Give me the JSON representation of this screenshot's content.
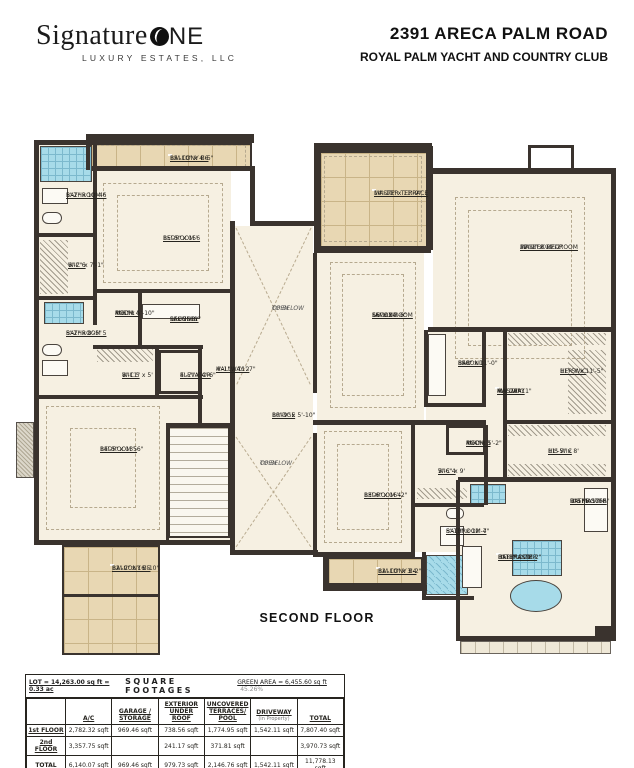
{
  "header": {
    "logo_script": "Signature",
    "logo_one": "NE",
    "logo_sub": "LUXURY ESTATES, LLC",
    "address": "2391 ARECA PALM ROAD",
    "community": "ROYAL PALM YACHT AND COUNTRY CLUB"
  },
  "floor_label": "SECOND FLOOR",
  "plan": {
    "floors": [
      {
        "x": 39,
        "y": 145,
        "w": 192,
        "h": 395
      },
      {
        "x": 235,
        "y": 226,
        "w": 78,
        "h": 324
      },
      {
        "x": 317,
        "y": 253,
        "w": 107,
        "h": 167
      },
      {
        "x": 433,
        "y": 174,
        "w": 178,
        "h": 153
      },
      {
        "x": 426,
        "y": 332,
        "w": 185,
        "h": 145
      },
      {
        "x": 460,
        "y": 482,
        "w": 151,
        "h": 154
      },
      {
        "x": 317,
        "y": 425,
        "w": 167,
        "h": 127
      }
    ],
    "balconies": [
      {
        "x": 90,
        "y": 143,
        "w": 162,
        "h": 27
      },
      {
        "x": 319,
        "y": 151,
        "w": 109,
        "h": 97
      },
      {
        "x": 327,
        "y": 557,
        "w": 96,
        "h": 28
      },
      {
        "x": 62,
        "y": 545,
        "w": 98,
        "h": 110
      }
    ],
    "band": [
      {
        "x": 460,
        "y": 641,
        "w": 151,
        "h": 13
      }
    ],
    "tiles": [
      {
        "x": 40,
        "y": 146,
        "w": 52,
        "h": 36
      },
      {
        "x": 44,
        "y": 302,
        "w": 40,
        "h": 22
      },
      {
        "x": 426,
        "y": 555,
        "w": 42,
        "h": 40,
        "d": 1
      },
      {
        "x": 512,
        "y": 540,
        "w": 50,
        "h": 36
      },
      {
        "x": 470,
        "y": 484,
        "w": 36,
        "h": 20
      }
    ],
    "stairs": [
      {
        "x": 168,
        "y": 426,
        "w": 62,
        "h": 112
      }
    ],
    "hatches": [
      {
        "x": 40,
        "y": 240,
        "w": 28,
        "h": 54
      },
      {
        "x": 97,
        "y": 349,
        "w": 56,
        "h": 13
      },
      {
        "x": 508,
        "y": 333,
        "w": 98,
        "h": 12
      },
      {
        "x": 568,
        "y": 350,
        "w": 38,
        "h": 64
      },
      {
        "x": 508,
        "y": 425,
        "w": 98,
        "h": 11
      },
      {
        "x": 508,
        "y": 464,
        "w": 98,
        "h": 12
      },
      {
        "x": 417,
        "y": 488,
        "w": 50,
        "h": 11
      }
    ],
    "crosses": [
      {
        "x": 236,
        "y": 228,
        "w": 75,
        "h": 158
      },
      {
        "x": 236,
        "y": 437,
        "w": 75,
        "h": 110
      }
    ],
    "dashes": [
      {
        "x": 103,
        "y": 183,
        "w": 120,
        "h": 100
      },
      {
        "x": 117,
        "y": 195,
        "w": 92,
        "h": 76
      },
      {
        "x": 46,
        "y": 406,
        "w": 114,
        "h": 124
      },
      {
        "x": 70,
        "y": 428,
        "w": 66,
        "h": 80
      },
      {
        "x": 455,
        "y": 197,
        "w": 130,
        "h": 162
      },
      {
        "x": 468,
        "y": 210,
        "w": 104,
        "h": 136
      },
      {
        "x": 330,
        "y": 262,
        "w": 86,
        "h": 146
      },
      {
        "x": 342,
        "y": 274,
        "w": 62,
        "h": 122
      },
      {
        "x": 324,
        "y": 431,
        "w": 78,
        "h": 112
      },
      {
        "x": 337,
        "y": 444,
        "w": 52,
        "h": 86
      },
      {
        "x": 324,
        "y": 156,
        "w": 98,
        "h": 86
      },
      {
        "x": 96,
        "y": 145,
        "w": 150,
        "h": 22
      }
    ],
    "fixtures": [
      {
        "x": 42,
        "y": 188,
        "w": 26,
        "h": 16
      },
      {
        "x": 42,
        "y": 212,
        "w": 20,
        "h": 12,
        "r": 6
      },
      {
        "x": 42,
        "y": 344,
        "w": 20,
        "h": 12,
        "r": 6
      },
      {
        "x": 42,
        "y": 360,
        "w": 26,
        "h": 16
      },
      {
        "x": 142,
        "y": 304,
        "w": 58,
        "h": 15
      },
      {
        "x": 428,
        "y": 334,
        "w": 18,
        "h": 62
      },
      {
        "x": 446,
        "y": 508,
        "w": 18,
        "h": 11,
        "r": 5
      },
      {
        "x": 440,
        "y": 526,
        "w": 24,
        "h": 20
      },
      {
        "x": 584,
        "y": 488,
        "w": 24,
        "h": 44
      },
      {
        "x": 462,
        "y": 546,
        "w": 20,
        "h": 42
      }
    ],
    "tubs": [
      {
        "x": 510,
        "y": 580,
        "w": 52,
        "h": 32
      }
    ],
    "misc": [
      {
        "c": "chim",
        "x": 16,
        "y": 422,
        "w": 18,
        "h": 56
      },
      {
        "c": "notch",
        "x": 528,
        "y": 145,
        "w": 46,
        "h": 26
      },
      {
        "c": "elevbox",
        "x": 158,
        "y": 350,
        "w": 44,
        "h": 44
      },
      {
        "c": "mechbox",
        "x": 446,
        "y": 425,
        "w": 40,
        "h": 30
      }
    ],
    "walls": [
      {
        "x": 34,
        "y": 140,
        "w": 64,
        "h": 5
      },
      {
        "x": 34,
        "y": 140,
        "w": 5,
        "h": 405
      },
      {
        "x": 86,
        "y": 134,
        "w": 168,
        "h": 9
      },
      {
        "x": 86,
        "y": 134,
        "w": 4,
        "h": 36
      },
      {
        "x": 92,
        "y": 166,
        "w": 163,
        "h": 5
      },
      {
        "x": 250,
        "y": 166,
        "w": 5,
        "h": 60
      },
      {
        "x": 250,
        "y": 221,
        "w": 68,
        "h": 5
      },
      {
        "x": 230,
        "y": 221,
        "w": 5,
        "h": 334
      },
      {
        "x": 34,
        "y": 540,
        "w": 200,
        "h": 5
      },
      {
        "x": 232,
        "y": 550,
        "w": 86,
        "h": 5
      },
      {
        "x": 314,
        "y": 143,
        "w": 118,
        "h": 8
      },
      {
        "x": 314,
        "y": 143,
        "w": 5,
        "h": 110
      },
      {
        "x": 428,
        "y": 146,
        "w": 5,
        "h": 104
      },
      {
        "x": 314,
        "y": 248,
        "w": 117,
        "h": 5
      },
      {
        "x": 428,
        "y": 168,
        "w": 188,
        "h": 6
      },
      {
        "x": 611,
        "y": 168,
        "w": 5,
        "h": 472
      },
      {
        "x": 428,
        "y": 327,
        "w": 188,
        "h": 5
      },
      {
        "x": 313,
        "y": 253,
        "w": 4,
        "h": 140
      },
      {
        "x": 313,
        "y": 433,
        "w": 4,
        "h": 122
      },
      {
        "x": 424,
        "y": 330,
        "w": 4,
        "h": 77
      },
      {
        "x": 424,
        "y": 403,
        "w": 60,
        "h": 4
      },
      {
        "x": 482,
        "y": 330,
        "w": 4,
        "h": 77
      },
      {
        "x": 503,
        "y": 330,
        "w": 4,
        "h": 151
      },
      {
        "x": 505,
        "y": 420,
        "w": 108,
        "h": 4
      },
      {
        "x": 458,
        "y": 477,
        "w": 155,
        "h": 5
      },
      {
        "x": 313,
        "y": 420,
        "w": 173,
        "h": 5
      },
      {
        "x": 411,
        "y": 425,
        "w": 4,
        "h": 130
      },
      {
        "x": 484,
        "y": 425,
        "w": 4,
        "h": 80
      },
      {
        "x": 415,
        "y": 503,
        "w": 69,
        "h": 4
      },
      {
        "x": 313,
        "y": 552,
        "w": 102,
        "h": 5
      },
      {
        "x": 323,
        "y": 585,
        "w": 104,
        "h": 6
      },
      {
        "x": 323,
        "y": 557,
        "w": 4,
        "h": 32
      },
      {
        "x": 456,
        "y": 480,
        "w": 4,
        "h": 160
      },
      {
        "x": 456,
        "y": 636,
        "w": 160,
        "h": 5
      },
      {
        "x": 93,
        "y": 145,
        "w": 4,
        "h": 180
      },
      {
        "x": 38,
        "y": 233,
        "w": 58,
        "h": 4
      },
      {
        "x": 38,
        "y": 296,
        "w": 58,
        "h": 4
      },
      {
        "x": 93,
        "y": 289,
        "w": 141,
        "h": 4
      },
      {
        "x": 138,
        "y": 293,
        "w": 4,
        "h": 55
      },
      {
        "x": 93,
        "y": 345,
        "w": 110,
        "h": 4
      },
      {
        "x": 155,
        "y": 347,
        "w": 4,
        "h": 50
      },
      {
        "x": 198,
        "y": 347,
        "w": 4,
        "h": 76
      },
      {
        "x": 38,
        "y": 395,
        "w": 165,
        "h": 4
      },
      {
        "x": 166,
        "y": 423,
        "w": 3,
        "h": 120
      },
      {
        "x": 168,
        "y": 423,
        "w": 65,
        "h": 3
      },
      {
        "x": 422,
        "y": 552,
        "w": 4,
        "h": 48
      },
      {
        "x": 422,
        "y": 596,
        "w": 52,
        "h": 4
      },
      {
        "x": 62,
        "y": 594,
        "w": 98,
        "h": 3
      },
      {
        "x": 595,
        "y": 626,
        "w": 20,
        "h": 12
      }
    ],
    "labels": [
      {
        "x": 170,
        "y": 155,
        "chip": 1,
        "lines": [
          {
            "t": "BALCONY B6",
            "u": 1
          },
          {
            "t": "15'-10\" x 4'-5\""
          }
        ]
      },
      {
        "x": 66,
        "y": 192,
        "lines": [
          {
            "t": "BATHROOM 6",
            "u": 1
          },
          {
            "t": "5'-2\" x 10'-4\""
          }
        ]
      },
      {
        "x": 163,
        "y": 235,
        "lines": [
          {
            "t": "BEDROOM 6",
            "u": 1
          },
          {
            "t": "15'-5\" x 15'"
          }
        ]
      },
      {
        "x": 68,
        "y": 262,
        "lines": [
          {
            "t": "WIC 6",
            "u": 1
          },
          {
            "t": "6'-2\" x 7'-1\""
          }
        ]
      },
      {
        "x": 115,
        "y": 310,
        "lines": [
          {
            "t": "MECH.",
            "u": 1
          },
          {
            "t": "ROOM 4",
            "u": 1
          },
          {
            "t": "4'-6\" x 5'-10\""
          }
        ]
      },
      {
        "x": 170,
        "y": 316,
        "lines": [
          {
            "t": "SECOND",
            "u": 1
          },
          {
            "t": "LAUNDRY",
            "u": 1
          },
          {
            "t": "9' x 7'-11\""
          }
        ]
      },
      {
        "x": 66,
        "y": 330,
        "lines": [
          {
            "t": "BATHROOM 5",
            "u": 1
          },
          {
            "t": "5'-2\" x 8'-5\""
          }
        ]
      },
      {
        "x": 122,
        "y": 372,
        "lines": [
          {
            "t": "WIC 5",
            "u": 1
          },
          {
            "t": "8'-11\" x 5'"
          }
        ]
      },
      {
        "x": 180,
        "y": 372,
        "lines": [
          {
            "t": "ELEVATOR",
            "u": 1
          },
          {
            "t": "4'-7\" x 4'-6\""
          }
        ]
      },
      {
        "x": 216,
        "y": 366,
        "lines": [
          {
            "t": "HALLWAY 2",
            "u": 1
          },
          {
            "t": "4'-1\" x 11'-7\""
          }
        ]
      },
      {
        "x": 100,
        "y": 446,
        "lines": [
          {
            "t": "BEDROOM 5",
            "u": 1
          },
          {
            "t": "14'-5\" x 13'-6\""
          }
        ]
      },
      {
        "x": 272,
        "y": 305,
        "lines": [
          {
            "t": "OPEN",
            "i": 1
          },
          {
            "t": "TO BELOW",
            "i": 1
          }
        ]
      },
      {
        "x": 272,
        "y": 412,
        "lines": [
          {
            "t": "BRIDGE",
            "u": 1
          },
          {
            "t": "10'-9\" x 5'-10\""
          }
        ]
      },
      {
        "x": 260,
        "y": 460,
        "lines": [
          {
            "t": "OPEN",
            "i": 1
          },
          {
            "t": "TO BELOW",
            "i": 1
          }
        ]
      },
      {
        "x": 372,
        "y": 312,
        "lines": [
          {
            "t": "SECOND",
            "u": 1
          },
          {
            "t": "FAMILY ROOM",
            "u": 1
          },
          {
            "t": "16' x 24'-6\""
          }
        ]
      },
      {
        "x": 374,
        "y": 190,
        "chip": 1,
        "lines": [
          {
            "t": "MASTER TERRACE",
            "u": 1
          },
          {
            "t": "14'-10\" x 11'-9\""
          }
        ]
      },
      {
        "x": 520,
        "y": 244,
        "lines": [
          {
            "t": "MASTER BEDROOM",
            "u": 1
          },
          {
            "t": "BEDROOM 3",
            "i": 1
          },
          {
            "t": "22'-1\" x 19'-2\""
          }
        ]
      },
      {
        "x": 458,
        "y": 360,
        "lines": [
          {
            "t": "SECOND",
            "u": 1
          },
          {
            "t": "BAR",
            "u": 1
          },
          {
            "t": "8'-0\" x 11'-0\""
          }
        ]
      },
      {
        "x": 497,
        "y": 388,
        "chip": 1,
        "lines": [
          {
            "t": "MASTER",
            "u": 1
          },
          {
            "t": "HALLWAY",
            "u": 1
          },
          {
            "t": "4' x 24'-11\""
          }
        ]
      },
      {
        "x": 560,
        "y": 368,
        "lines": [
          {
            "t": "HER WIC",
            "u": 1
          },
          {
            "t": "11'-5\" x 11'-5\""
          }
        ]
      },
      {
        "x": 548,
        "y": 448,
        "lines": [
          {
            "t": "HIS WIC",
            "u": 1
          },
          {
            "t": "11'-5\" x 8'"
          }
        ]
      },
      {
        "x": 466,
        "y": 440,
        "lines": [
          {
            "t": "MECH.",
            "u": 1
          },
          {
            "t": "ROOM 3",
            "u": 1
          },
          {
            "t": "4'-4\" x 5'-2\""
          }
        ]
      },
      {
        "x": 438,
        "y": 468,
        "lines": [
          {
            "t": "WIC 4",
            "u": 1
          },
          {
            "t": "5'-6\" x 9'"
          }
        ]
      },
      {
        "x": 364,
        "y": 492,
        "lines": [
          {
            "t": "BEDROOM 4",
            "u": 1
          },
          {
            "t": "13'-6\" x 16'-2\""
          }
        ]
      },
      {
        "x": 446,
        "y": 528,
        "chip": 1,
        "lines": [
          {
            "t": "BATHROOM 4",
            "u": 1
          },
          {
            "t": "5'-10\" x 12'-7\""
          }
        ]
      },
      {
        "x": 570,
        "y": 498,
        "lines": [
          {
            "t": "HIS MASTER",
            "u": 1
          },
          {
            "t": "BATHROOM",
            "u": 1
          },
          {
            "t": "9'-5\" x 17'-6\""
          }
        ]
      },
      {
        "x": 498,
        "y": 554,
        "chip": 1,
        "lines": [
          {
            "t": "HER MASTER",
            "u": 1
          },
          {
            "t": "BATHROOM",
            "u": 1
          },
          {
            "t": "8'-11\" x 21'-2\""
          }
        ]
      },
      {
        "x": 378,
        "y": 568,
        "chip": 1,
        "lines": [
          {
            "t": "BALCONY B4",
            "u": 1
          },
          {
            "t": "11'-10\" x 3'-2\""
          }
        ]
      },
      {
        "x": 112,
        "y": 565,
        "chip": 1,
        "lines": [
          {
            "t": "BALCONY B5",
            "u": 1
          },
          {
            "t": "12'-9\" x 16'-10\""
          }
        ]
      }
    ]
  },
  "table": {
    "lot_label": "LOT = 14,263.00 sq ft = 0.33 ac",
    "title": "SQUARE FOOTAGES",
    "green_label": "GREEN AREA = 6,455.60 sq ft",
    "green_pct": "45.26%",
    "columns": [
      {
        "lines": [
          {
            "t": "A/C",
            "u": 1
          }
        ]
      },
      {
        "lines": [
          {
            "t": "GARAGE /",
            "u": 1
          },
          {
            "t": "STORAGE",
            "u": 1
          }
        ]
      },
      {
        "lines": [
          {
            "t": "EXTERIOR",
            "u": 1
          },
          {
            "t": "UNDER ROOF",
            "u": 1
          }
        ]
      },
      {
        "lines": [
          {
            "t": "UNCOVERED",
            "u": 1
          },
          {
            "t": "TERRACES/ POOL",
            "u": 1
          }
        ]
      },
      {
        "lines": [
          {
            "t": "DRIVEWAY",
            "u": 1
          },
          {
            "t": "(in Property)",
            "small": 1
          }
        ]
      },
      {
        "lines": [
          {
            "t": "TOTAL",
            "u": 1
          }
        ]
      }
    ],
    "rows": [
      {
        "label": "1st FLOOR",
        "cells": [
          "2,782.32 sqft",
          "969.46 sqft",
          "738.56 sqft",
          "1,774.95 sqft",
          "1,542.11 sqft",
          "7,807.40 sqft"
        ]
      },
      {
        "label": "2nd FLOOR",
        "cells": [
          "3,357.75 sqft",
          "",
          "241.17 sqft",
          "371.81 sqft",
          "",
          "3,970.73 sqft"
        ]
      },
      {
        "label": "TOTAL",
        "cells": [
          "6,140.07 sqft",
          "969.46 sqft",
          "979.73 sqft",
          "2,146.76 sqft",
          "1,542.11 sqft",
          "11,778.13 sqft"
        ]
      }
    ]
  }
}
